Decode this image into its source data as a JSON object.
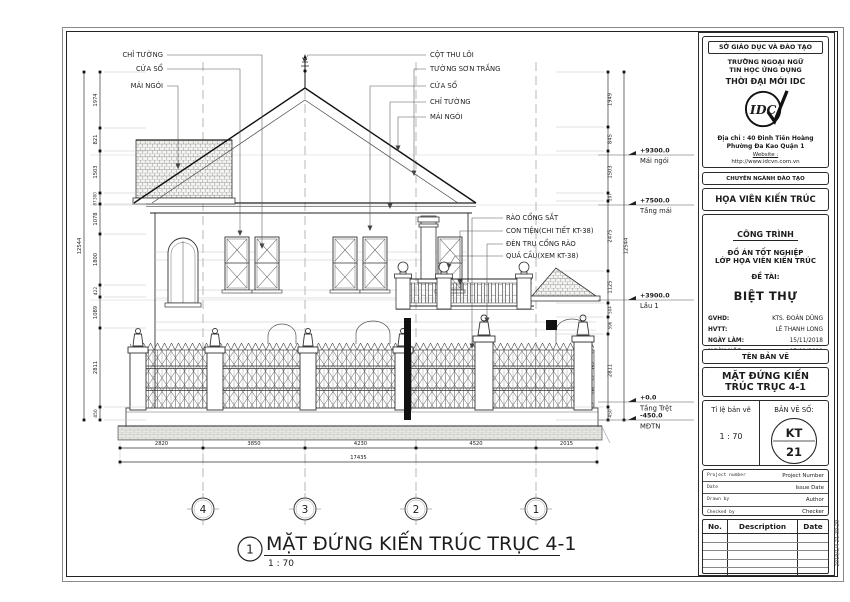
{
  "drawing": {
    "callouts_left": [
      "CHỈ TƯỜNG",
      "CỬA SỔ",
      "MÁI NGÓI"
    ],
    "callouts_center": [
      "CỘT THU LÔI",
      "TƯỜNG SƠN TRẮNG",
      "CỬA SỔ",
      "CHỈ TƯỜNG",
      "MÁI NGÓI"
    ],
    "callouts_mid": [
      "RÀO CỔNG SẮT",
      "CON TIỆN(CHI TIẾT  KT-38)",
      "ĐÈN TRỤ CỔNG RÀO",
      "QUẢ CẦU(XEM KT-38)"
    ],
    "levels": [
      {
        "elev": "+9300.0",
        "name": "Mái ngói"
      },
      {
        "elev": "+7500.0",
        "name": "Tầng mái"
      },
      {
        "elev": "+3900.0",
        "name": "Lầu 1"
      },
      {
        "elev": "+0.0",
        "name": "Tầng Trệt"
      },
      {
        "elev": "-450.0",
        "name": "MĐTN"
      }
    ],
    "dims_left": [
      "1974",
      "821",
      "1503",
      "300",
      "87",
      "1078",
      "1800",
      "422",
      "1089",
      "2811",
      "450"
    ],
    "dims_left_total": "12544",
    "dims_right": [
      "1949",
      "845",
      "1503",
      "297",
      "2475",
      "1125",
      "504",
      "596",
      "2811",
      "450"
    ],
    "dims_right_total": "12544",
    "dims_bottom": [
      "2820",
      "3850",
      "4230",
      "4520",
      "2015"
    ],
    "dims_bottom_total": "17435",
    "grid_bubbles": [
      "4",
      "3",
      "2",
      "1"
    ],
    "view_number": "1",
    "view_title": "MẶT ĐỨNG KIẾN TRÚC TRỤC 4-1",
    "view_scale": "1 : 70"
  },
  "title_block": {
    "department": "SỞ GIÁO DỤC VÀ ĐÀO TẠO",
    "school_line1": "TRƯỜNG NGOẠI NGỮ",
    "school_line2": "TIN HỌC ỨNG DỤNG",
    "school_line3": "THỜI ĐẠI MỚI IDC",
    "logo_text": "IDC",
    "address_line1": "Địa chỉ : 40 Đinh Tiên Hoàng",
    "address_line2": "Phường Đa Kao Quận 1",
    "website_label": "Website :",
    "website_url": "http://www.idcvn.com.vn",
    "major_label": "CHUYÊN NGÀNH ĐÀO TẠO",
    "major_value": "HỌA VIÊN KIẾN TRÚC",
    "project_label": "CÔNG TRÌNH",
    "project_line1": "ĐỒ ÁN TỐT NGHIỆP",
    "project_line2": "LỚP HỌA VIÊN KIẾN TRÚC",
    "topic_label": "ĐỀ TÀI:",
    "topic_value": "BIỆT THỰ",
    "info_rows": [
      {
        "label": "GVHD:",
        "value": "KTS. ĐOÀN DŨNG"
      },
      {
        "label": "HVTT:",
        "value": "LÊ THANH LONG"
      },
      {
        "label": "NGÀY LÀM:",
        "value": "15/11/2018"
      },
      {
        "label": "NGÀY NỘP:",
        "value": "07/01/2019"
      }
    ],
    "sheet_name_label": "TÊN BẢN VẼ",
    "sheet_name_line1": "MẶT ĐỨNG KIẾN",
    "sheet_name_line2": "TRÚC TRỤC 4-1",
    "scale_label": "Tỉ lệ bản vẽ",
    "scale_value": "1 : 70",
    "sheet_no_label": "BẢN VẼ SỐ:",
    "sheet_no_line1": "KT",
    "sheet_no_line2": "21",
    "meta_rows": [
      {
        "label": "Project number",
        "value": "Project Number"
      },
      {
        "label": "Date",
        "value": "Issue Date"
      },
      {
        "label": "Drawn by",
        "value": "Author"
      },
      {
        "label": "Checked by",
        "value": "Checker"
      }
    ],
    "rev_headers": [
      "No.",
      "Description",
      "Date"
    ]
  },
  "timestamp": "2019/1/4 21:30:29",
  "colors": {
    "line": "#1c1c1c",
    "light_line": "#9a9a9a",
    "bg": "#ffffff"
  }
}
